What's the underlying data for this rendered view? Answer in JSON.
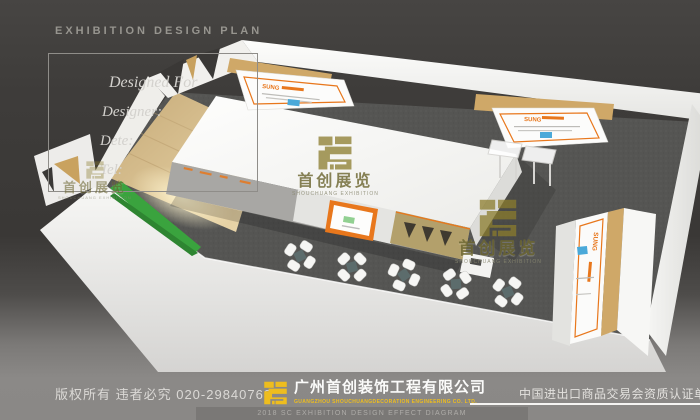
{
  "header": {
    "title": "EXHIBITION DESIGN PLAN"
  },
  "info_box": {
    "designed_for": "Designed For",
    "designer": "Designer:",
    "date": "Dete:",
    "tel": "Tel:"
  },
  "render": {
    "watermark_cn": "首创展览",
    "watermark_en": "SHOUCHUANG EXHIBITION",
    "panel_brand": "SUNG",
    "accent_orange": "#e8771c",
    "accent_blue": "#4aa9d9",
    "carpet_color": "#555553",
    "wood_color": "#d9c293",
    "plant_color": "#3aa33e"
  },
  "footer": {
    "copyright": "版权所有 违者必究 020-29840768",
    "company_cn": "广州首创装饰工程有限公司",
    "company_en": "GUANGZHOU SHOUCHUANGDECORATION ENGINEERING CO. LTD.",
    "diagram_label": "2018 SC EXHIBITION DESIGN EFFECT DIAGRAM",
    "certification": "中国进出口商品交易会资质认证单位",
    "logo_color": "#eebd1e"
  }
}
